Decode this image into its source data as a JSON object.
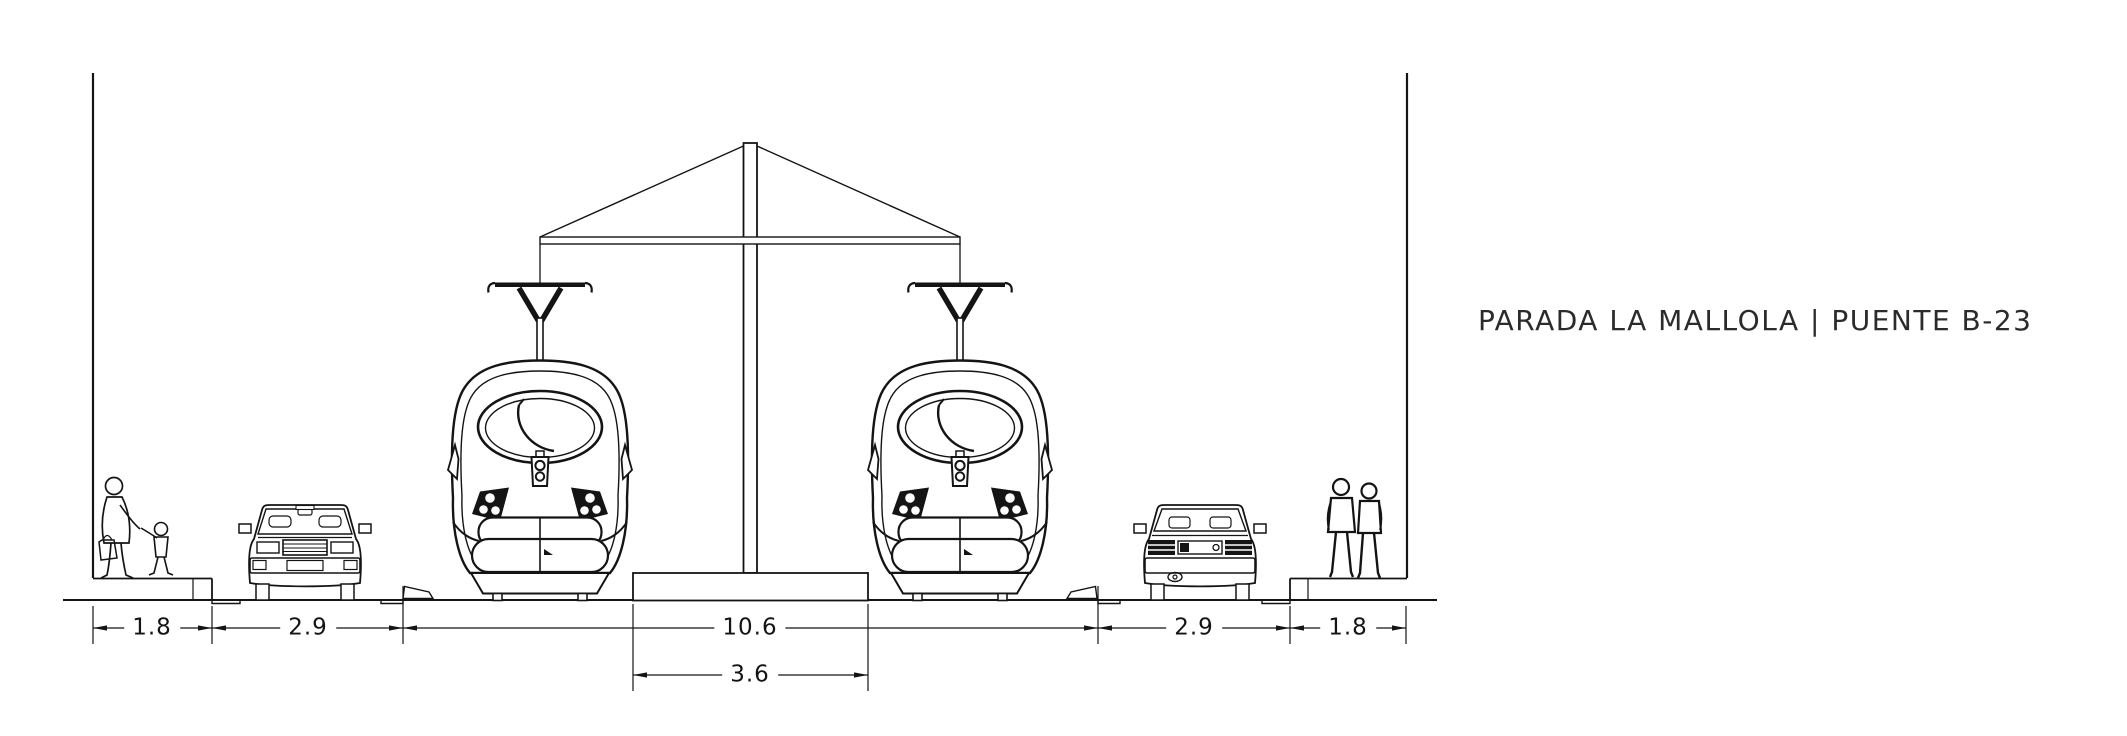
{
  "title": "PARADA LA MALLOLA | PUENTE B-23",
  "drawing": {
    "type": "street-cross-section-elevation",
    "dimensions": {
      "left_sidewalk": "1.8",
      "left_lane": "2.9",
      "track_zone": "10.6",
      "central_platform": "3.6",
      "right_lane": "2.9",
      "right_sidewalk": "1.8"
    },
    "scene": {
      "tram_left": "tram-front-view",
      "tram_right": "tram-front-view",
      "car_left": "car-front-view",
      "car_right": "car-rear-view",
      "pedestrians_left": "woman-with-child-and-bag",
      "pedestrians_right": "couple-walking-away",
      "shelter": "central-column-with-canopy-roof",
      "platform": "raised-central-platform",
      "walls": "section-cut-side-walls"
    },
    "colors": {
      "line": "#141414",
      "background": "#ffffff"
    }
  }
}
